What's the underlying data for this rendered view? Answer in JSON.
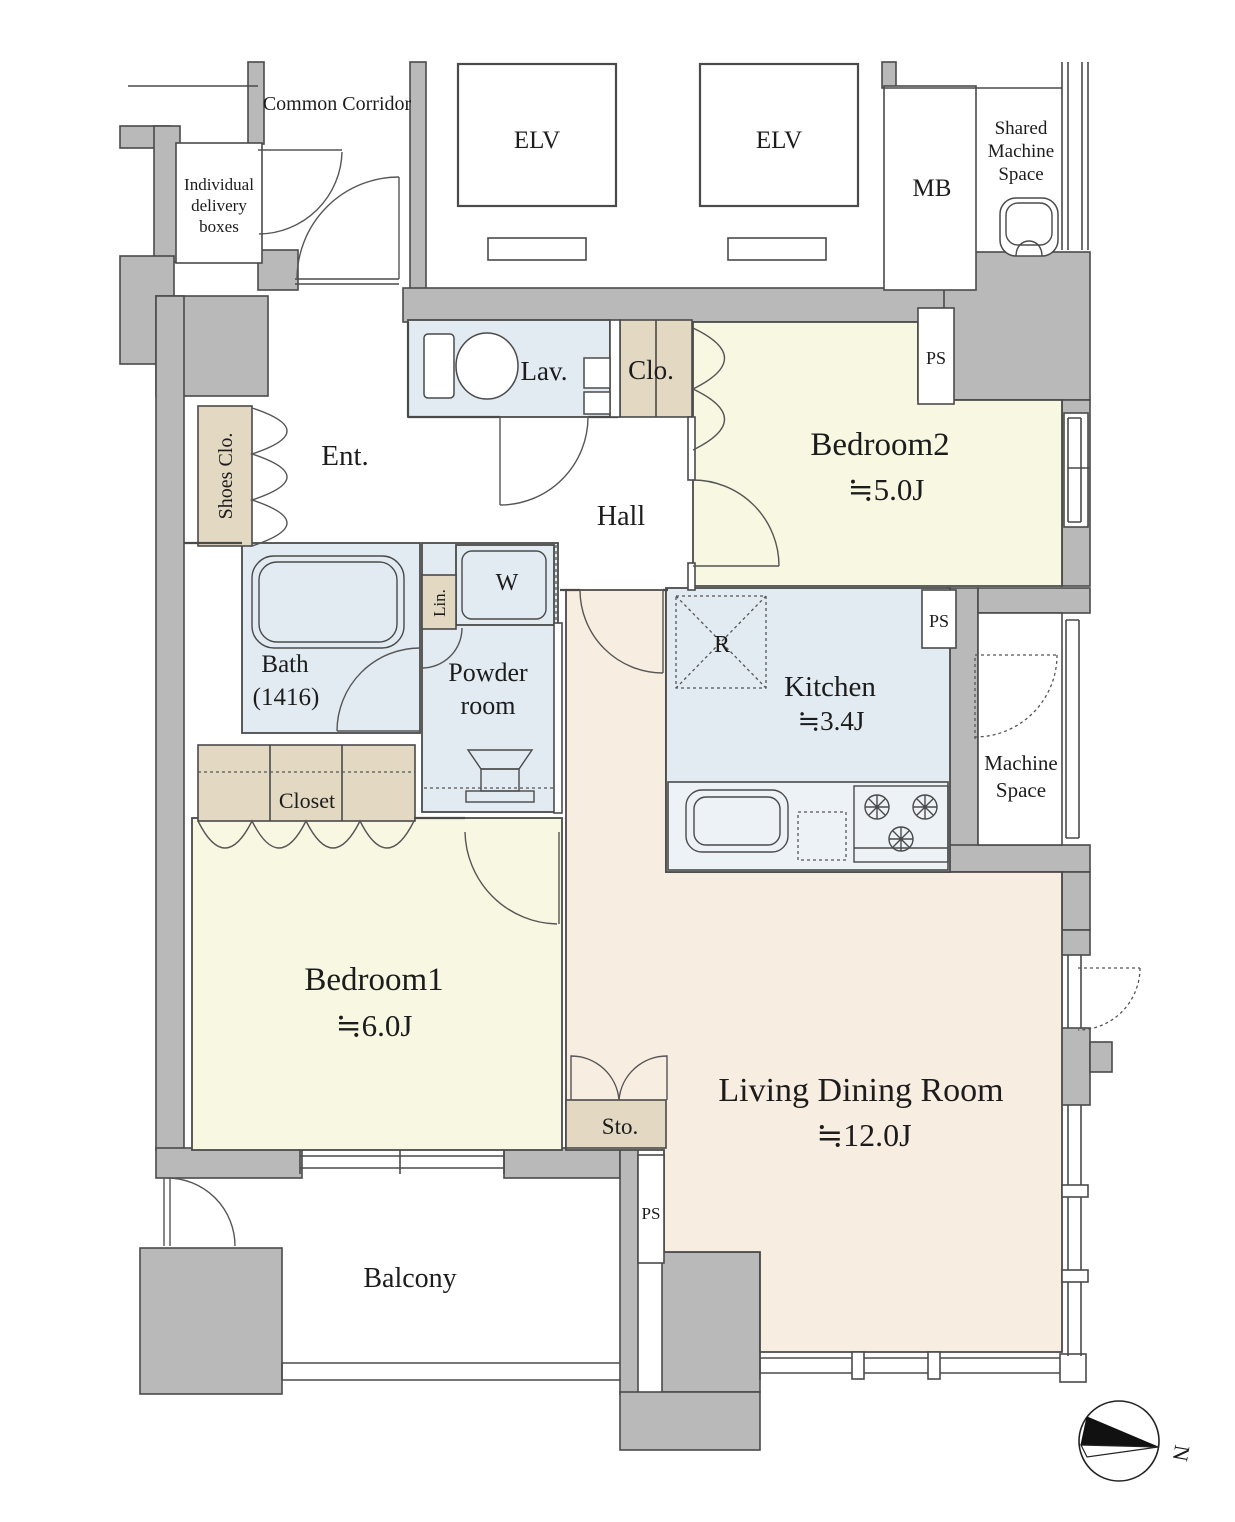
{
  "title": "Apartment Floor Plan 2LDK",
  "colors": {
    "wall": "#b9b9b9",
    "outline": "#4a4a4a",
    "bedroom": "#f7f7e2",
    "wet_area": "#e2ebf1",
    "living": "#f8ede1",
    "storage": "#e3d8c2",
    "background": "#ffffff"
  },
  "labels": {
    "common_corridor": "Common Corridor",
    "delivery": [
      "Individual",
      "delivery",
      "boxes"
    ],
    "elv": "ELV",
    "mb": "MB",
    "shared": [
      "Shared",
      "Machine",
      "Space"
    ],
    "ent": "Ent.",
    "shoes": "Shoes Clo.",
    "lav": "Lav.",
    "clo": "Clo.",
    "hall": "Hall",
    "bedroom2_name": "Bedroom2",
    "bedroom2_area": "≒5.0J",
    "bath_name": "Bath",
    "bath_size": "(1416)",
    "lin": "Lin.",
    "washer": "W",
    "powder": [
      "Powder",
      "room"
    ],
    "kitchen_name": "Kitchen",
    "kitchen_area": "≒3.4J",
    "fridge": "R",
    "machine": [
      "Machine",
      "Space"
    ],
    "closet": "Closet",
    "bedroom1_name": "Bedroom1",
    "bedroom1_area": "≒6.0J",
    "sto": "Sto.",
    "ldr_name": "Living Dining Room",
    "ldr_area": "≒12.0J",
    "balcony": "Balcony",
    "ps": "PS",
    "north": "N"
  }
}
